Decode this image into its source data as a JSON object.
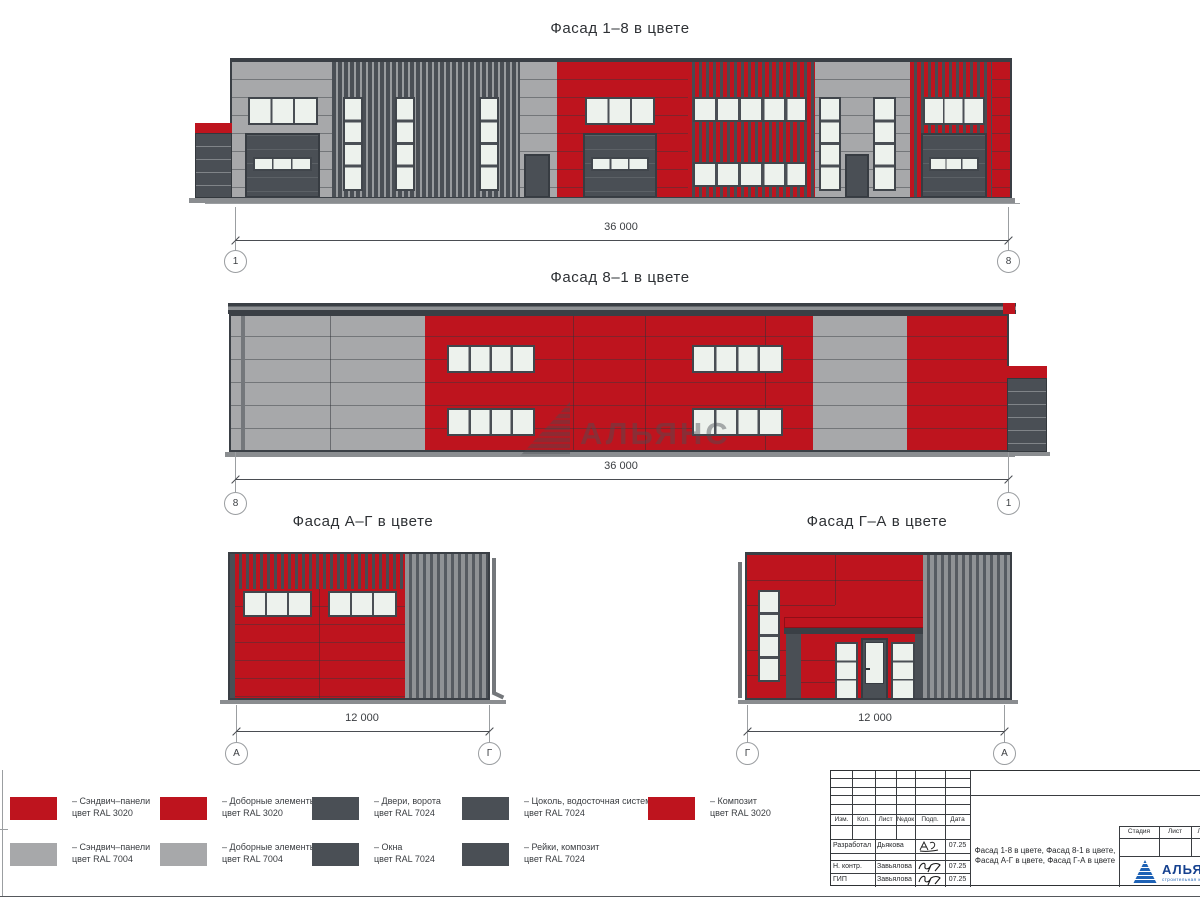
{
  "colors": {
    "ral3020_red": "#be141e",
    "ral7004_gray": "#a7a8aa",
    "ral7024_dark": "#4a4f55",
    "glass": "#edf2ed",
    "logo_blue": "#1e62b5",
    "logo_text_blue": "#15418f"
  },
  "facades": [
    {
      "title": "Фасад 1–8 в цвете",
      "dim": "36 000",
      "axisL": "1",
      "axisR": "8"
    },
    {
      "title": "Фасад 8–1 в цвете",
      "dim": "36 000",
      "axisL": "8",
      "axisR": "1"
    },
    {
      "title": "Фасад А–Г в цвете",
      "dim": "12 000",
      "axisL": "А",
      "axisR": "Г"
    },
    {
      "title": "Фасад Г–А в цвете",
      "dim": "12 000",
      "axisL": "Г",
      "axisR": "А"
    }
  ],
  "legend": {
    "items": [
      {
        "color": "#be141e",
        "line1": "– Сэндвич–панели",
        "line2": "цвет RAL 3020"
      },
      {
        "color": "#a7a8aa",
        "line1": "– Сэндвич–панели",
        "line2": "цвет RAL 7004"
      },
      {
        "color": "#be141e",
        "line1": "– Доборные элементы",
        "line2": "цвет RAL 3020"
      },
      {
        "color": "#a7a8aa",
        "line1": "– Доборные элементы",
        "line2": "цвет RAL 7004"
      },
      {
        "color": "#4a4f55",
        "line1": "– Двери, ворота",
        "line2": "цвет RAL 7024"
      },
      {
        "color": "#4a4f55",
        "line1": "– Окна",
        "line2": "цвет RAL 7024"
      },
      {
        "color": "#4a4f55",
        "line1": "– Цоколь, водосточная система",
        "line2": "цвет RAL 7024"
      },
      {
        "color": "#4a4f55",
        "line1": "– Рейки, композит",
        "line2": "цвет RAL 7024"
      },
      {
        "color": "#be141e",
        "line1": "– Композит",
        "line2": "цвет RAL 3020"
      }
    ]
  },
  "watermark": {
    "text": "АЛЬЯНС"
  },
  "stamp": {
    "cols": [
      "Изм.",
      "Кол.",
      "Лист",
      "№док",
      "Подп.",
      "Дата"
    ],
    "rows": [
      {
        "role": "Разработал",
        "name": "Дьякова",
        "date": "07.25"
      },
      {
        "role": "Н. контр.",
        "name": "Завьялова",
        "date": "07.25"
      },
      {
        "role": "ГИП",
        "name": "Завьялова",
        "date": "07.25"
      }
    ],
    "doc_title": "Фасад 1-8 в цвете, Фасад 8-1 в цвете, Фасад А-Г в цвете, Фасад Г-А в цвете",
    "right_cols": [
      "Стадия",
      "Лист",
      "Листов"
    ],
    "logo": {
      "name": "АЛЬЯНС",
      "sub": "строительная компания"
    }
  }
}
